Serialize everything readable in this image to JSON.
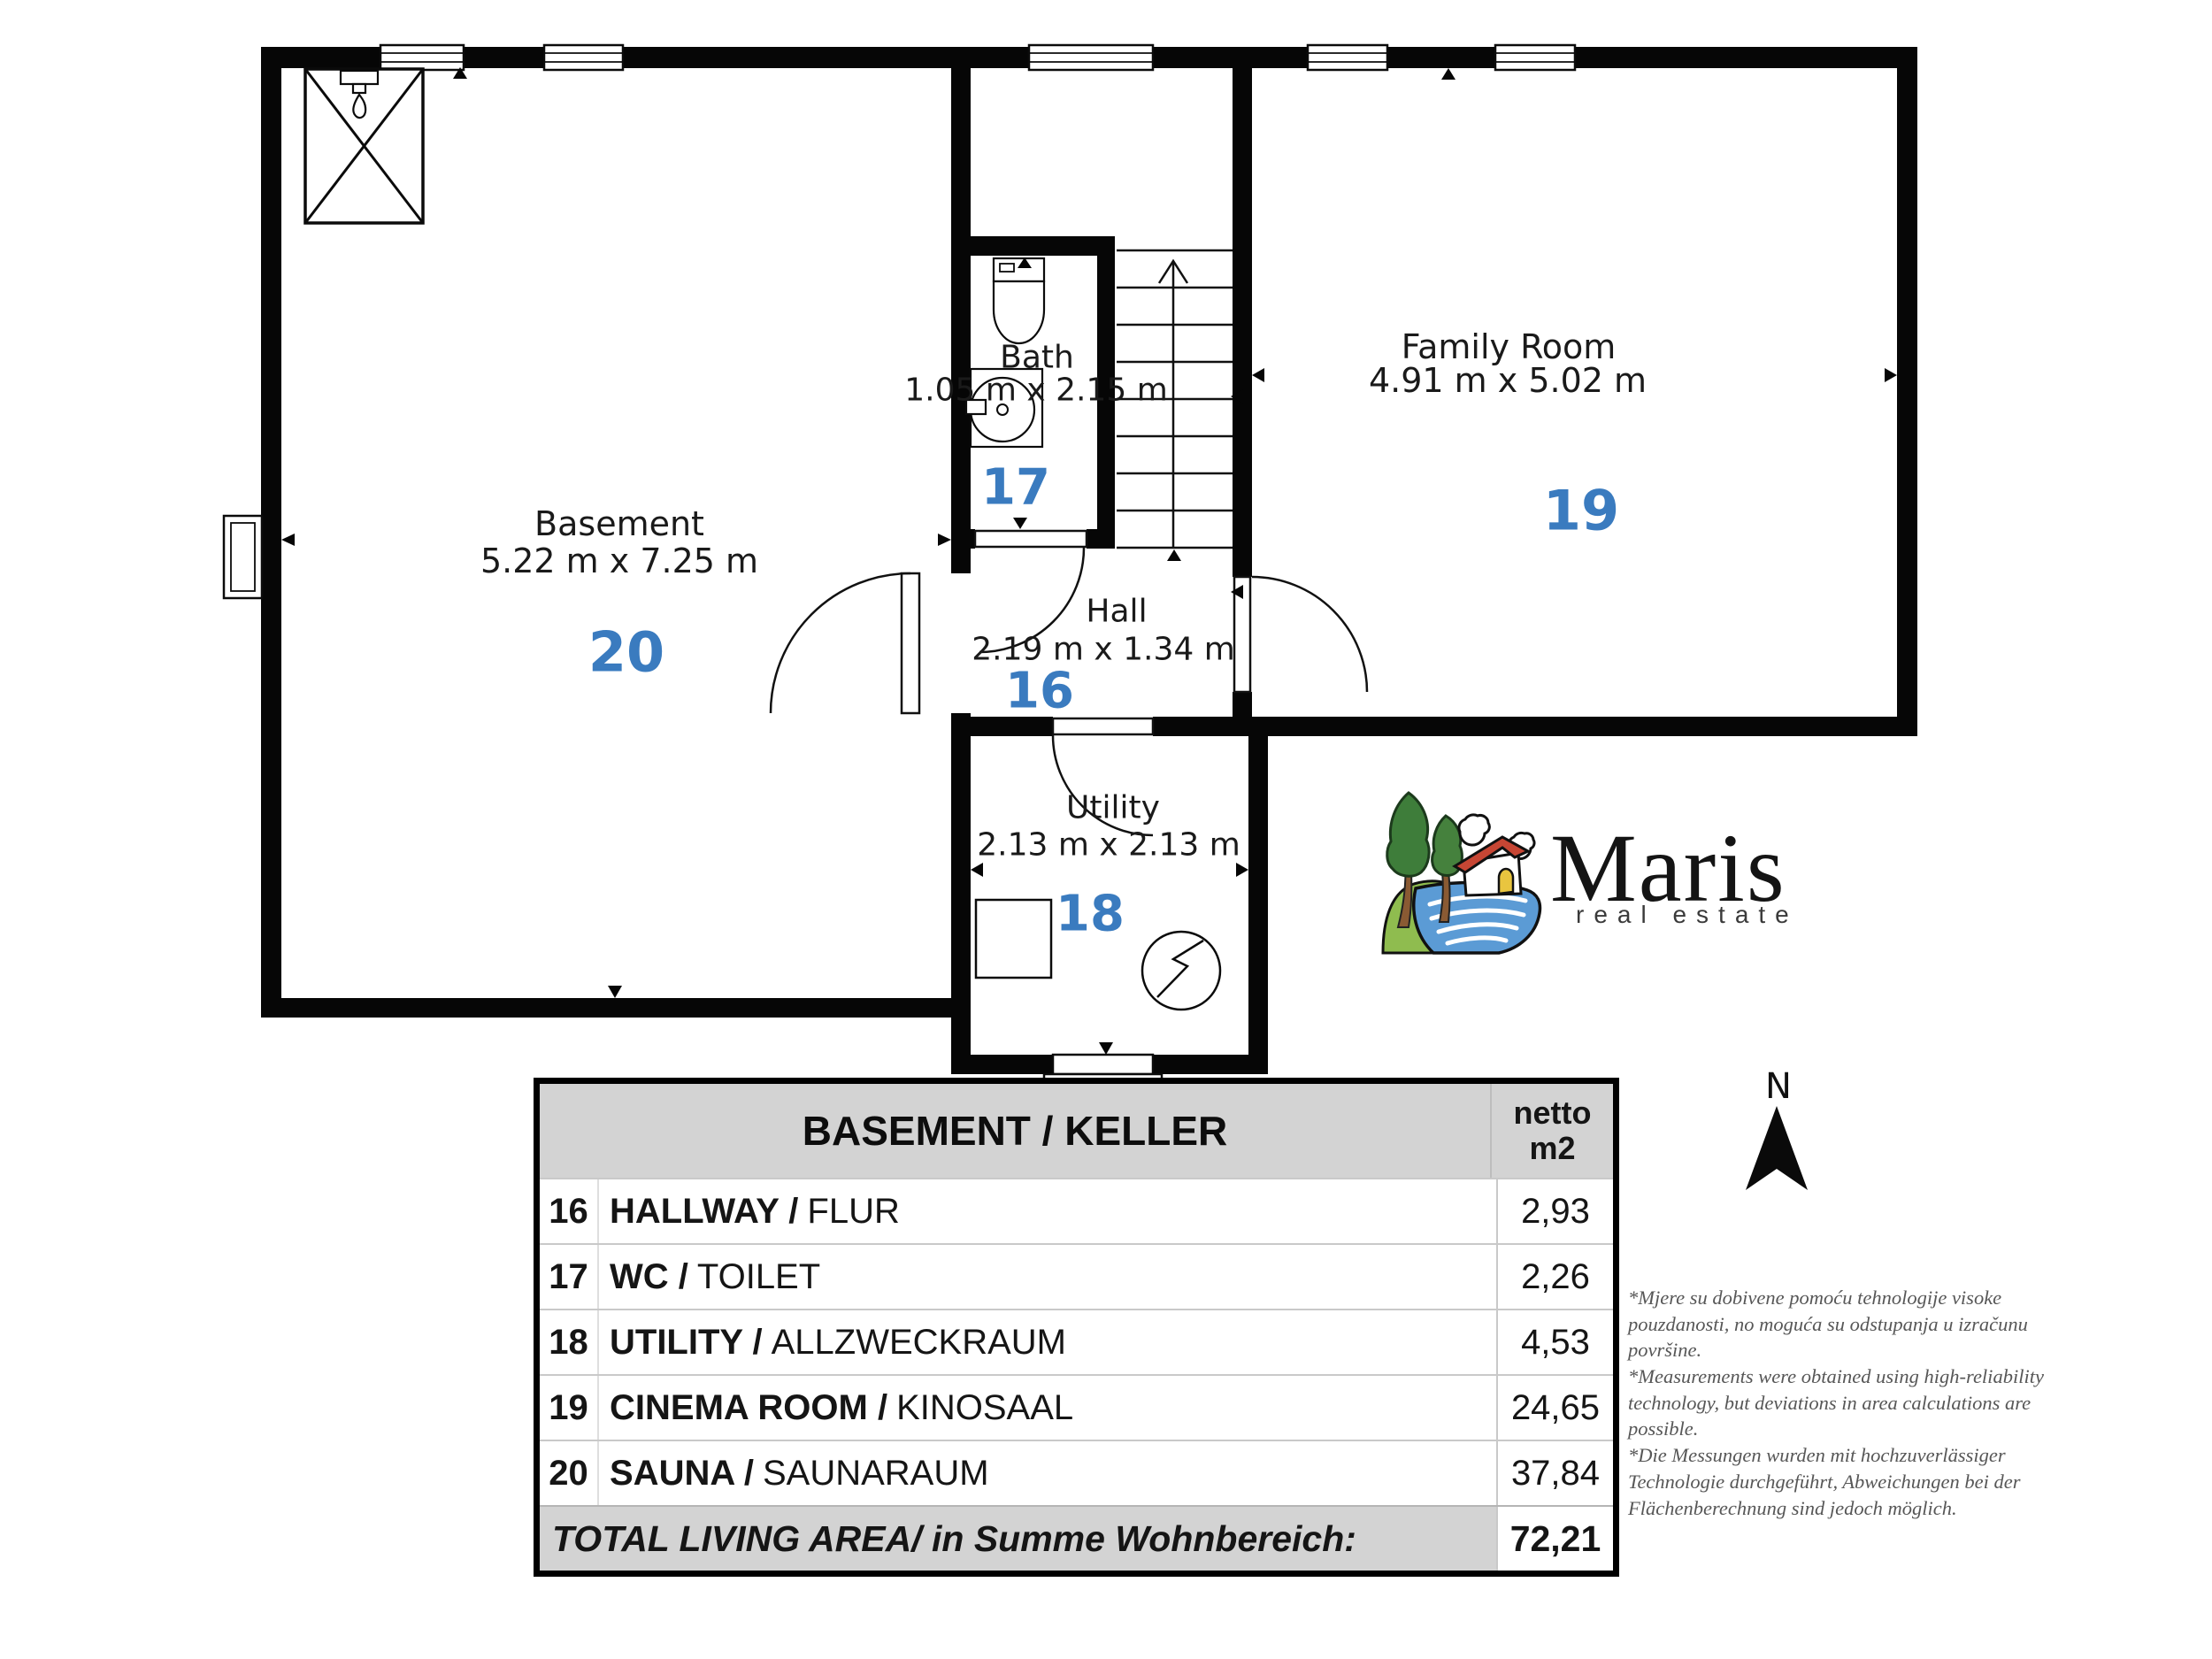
{
  "plan": {
    "rooms": {
      "basement": {
        "number": "20",
        "label": "Basement",
        "dimensions": "5.22 m x 7.25 m"
      },
      "bath": {
        "number": "17",
        "label": "Bath",
        "dimensions": "1.05 m x 2.15 m"
      },
      "family": {
        "number": "19",
        "label": "Family Room",
        "dimensions": "4.91 m x 5.02 m"
      },
      "hall": {
        "number": "16",
        "label": "Hall",
        "dimensions": "2.19 m x 1.34 m"
      },
      "utility": {
        "number": "18",
        "label": "Utility",
        "dimensions": "2.13 m x 2.13 m"
      }
    },
    "compass_label": "N",
    "icons": [
      "shower-icon",
      "toilet-icon",
      "sink-icon",
      "water-heater-icon",
      "stairs-up-icon",
      "window-symbol",
      "door-swing-symbol",
      "north-arrow-icon",
      "sauna-crossed-box"
    ]
  },
  "logo": {
    "brand": "Maris",
    "tagline": "real estate"
  },
  "table": {
    "title": "BASEMENT / KELLER",
    "unit_line1": "netto",
    "unit_line2": "m2",
    "rows": [
      {
        "num": "16",
        "name": "HALLWAY /",
        "alt": "FLUR",
        "value": "2,93"
      },
      {
        "num": "17",
        "name": "WC /",
        "alt": "TOILET",
        "value": "2,26"
      },
      {
        "num": "18",
        "name": "UTILITY /",
        "alt": "ALLZWECKRAUM",
        "value": "4,53"
      },
      {
        "num": "19",
        "name": "CINEMA ROOM /",
        "alt": "KINOSAAL",
        "value": "24,65"
      },
      {
        "num": "20",
        "name": "SAUNA /",
        "alt": "SAUNARAUM",
        "value": "37,84"
      }
    ],
    "total_label": "TOTAL LIVING AREA/ in Summe Wohnbereich:",
    "total_value": "72,21"
  },
  "disclaimer": {
    "lines": [
      "*Mjere su dobivene pomoću tehnologije visoke",
      "pouzdanosti, no moguća su odstupanja u izračunu",
      "površine.",
      "*Measurements were obtained using high-reliability",
      "technology, but deviations in area calculations are",
      "possible.",
      "*Die Messungen wurden mit hochzuverlässiger",
      "Technologie durchgeführt, Abweichungen bei der",
      "Flächenberechnung sind jedoch möglich."
    ]
  },
  "colors": {
    "room_number": "#3a7bbf",
    "walls": "#060606",
    "table_header_bg": "#d3d3d3",
    "logo_tree": "#3e7d3a",
    "logo_roof": "#c74634",
    "logo_water": "#5b9bd5",
    "logo_hill": "#8fbc4f",
    "logo_door": "#e9c53f"
  }
}
